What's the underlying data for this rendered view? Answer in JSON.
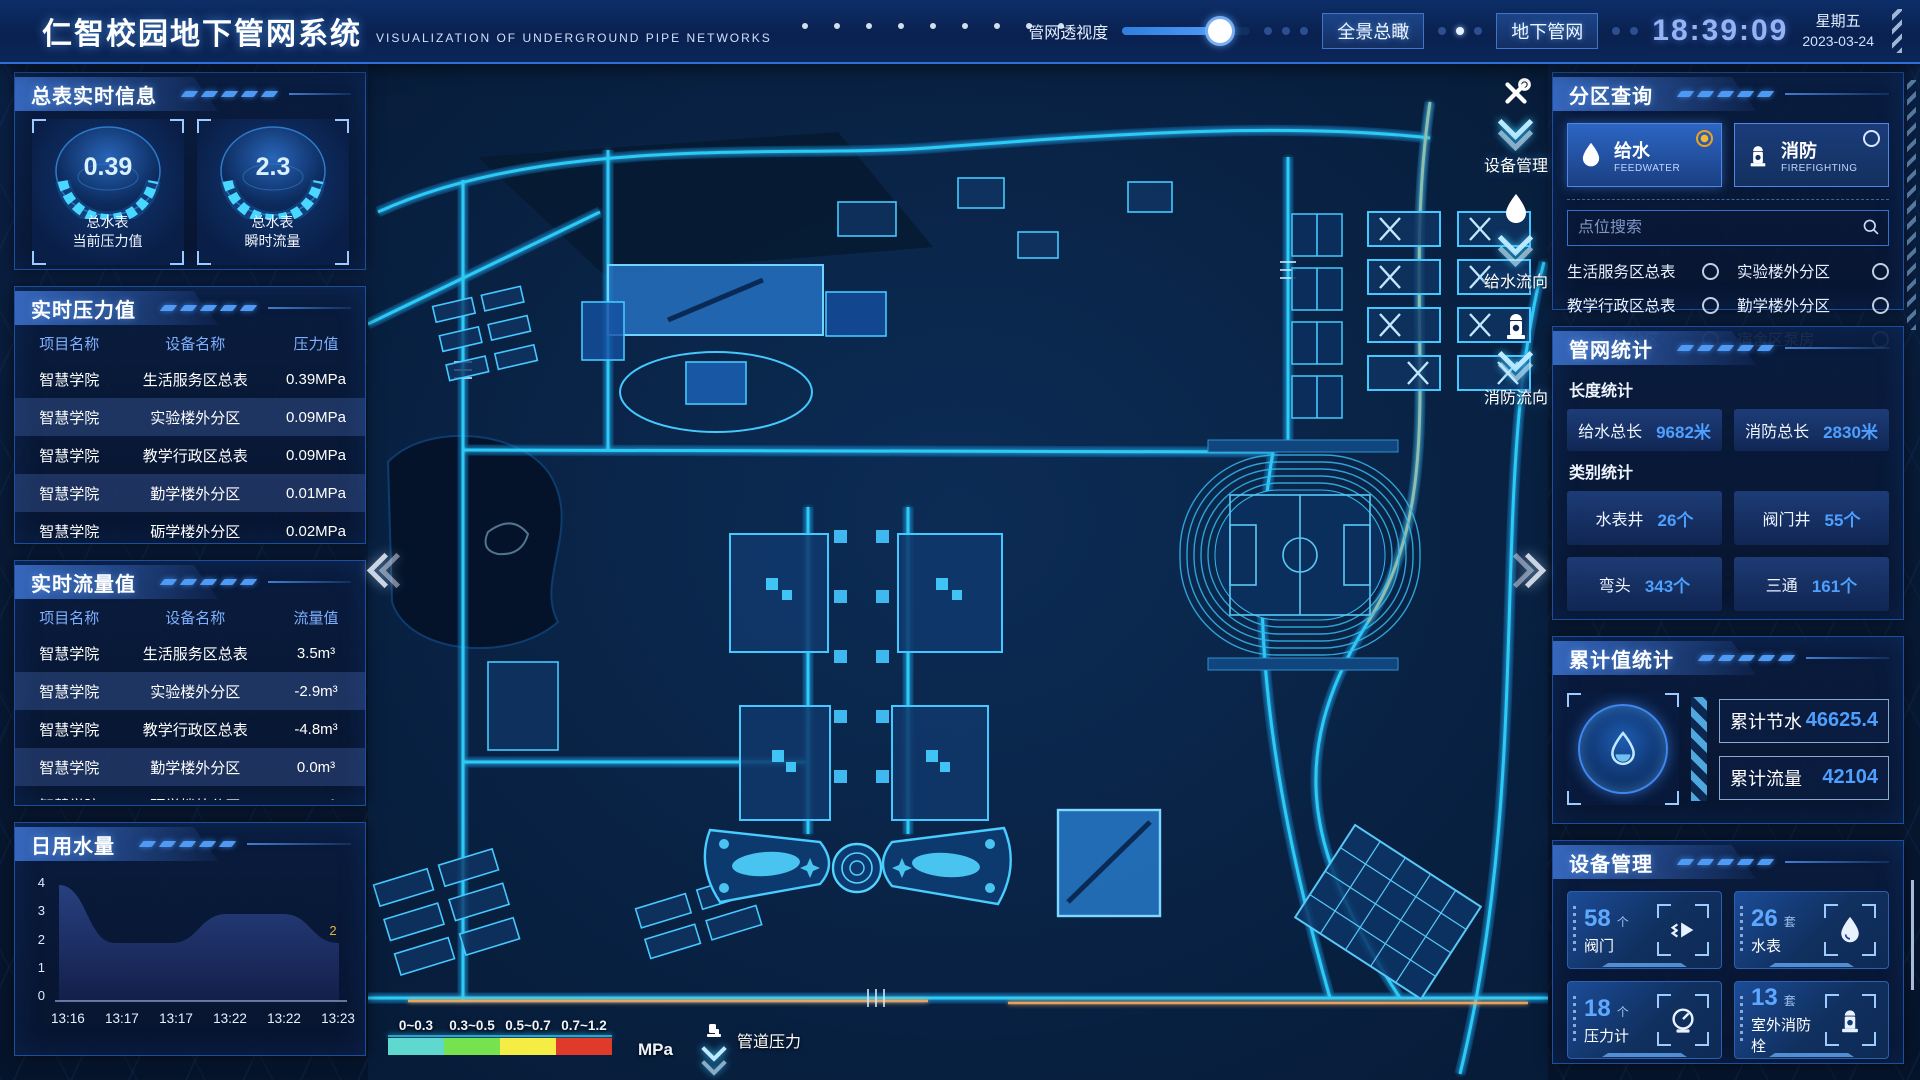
{
  "header": {
    "title": "仁智校园地下管网系统",
    "subtitle": "VISUALIZATION OF UNDERGROUND PIPE NETWORKS",
    "slider_label": "管网透视度",
    "btn_overview": "全景总瞰",
    "btn_underground": "地下管网",
    "time": "18:39:09",
    "weekday": "星期五",
    "date": "2023-03-24"
  },
  "left": {
    "meter_info": {
      "title": "总表实时信息",
      "gauges": [
        {
          "value": "0.39",
          "label1": "总水表",
          "label2": "当前压力值"
        },
        {
          "value": "2.3",
          "label1": "总水表",
          "label2": "瞬时流量"
        }
      ]
    },
    "pressure": {
      "title": "实时压力值",
      "headers": [
        "项目名称",
        "设备名称",
        "压力值"
      ],
      "rows": [
        [
          "智慧学院",
          "生活服务区总表",
          "0.39MPa"
        ],
        [
          "智慧学院",
          "实验楼外分区",
          "0.09MPa"
        ],
        [
          "智慧学院",
          "教学行政区总表",
          "0.09MPa"
        ],
        [
          "智慧学院",
          "勤学楼外分区",
          "0.01MPa"
        ],
        [
          "智慧学院",
          "砺学楼外分区",
          "0.02MPa"
        ]
      ]
    },
    "flow": {
      "title": "实时流量值",
      "headers": [
        "项目名称",
        "设备名称",
        "流量值"
      ],
      "rows": [
        [
          "智慧学院",
          "生活服务区总表",
          "3.5m³"
        ],
        [
          "智慧学院",
          "实验楼外分区",
          "-2.9m³"
        ],
        [
          "智慧学院",
          "教学行政区总表",
          "-4.8m³"
        ],
        [
          "智慧学院",
          "勤学楼外分区",
          "0.0m³"
        ],
        [
          "智慧学院",
          "砺学楼外分区",
          "2.3m³"
        ]
      ]
    },
    "daily": {
      "title": "日用水量"
    }
  },
  "chart_data": {
    "type": "area",
    "title": "日用水量",
    "x": [
      "13:16",
      "13:17",
      "13:17",
      "13:22",
      "13:22",
      "13:23"
    ],
    "values": [
      4,
      2,
      2,
      3,
      3,
      2
    ],
    "ylim": [
      0,
      4
    ],
    "yticks": [
      "4",
      "3",
      "2",
      "1",
      "0"
    ],
    "end_label": "2",
    "grid": false,
    "legend_position": "none"
  },
  "map": {
    "tools": [
      {
        "icon": "wrench-icon",
        "label": "设备管理"
      },
      {
        "icon": "waterdrop-icon",
        "label": "给水流向"
      },
      {
        "icon": "hydrant-icon",
        "label": "消防流向"
      }
    ],
    "legend": {
      "ranges": [
        {
          "label": "0~0.3",
          "color": "#5fd8cf"
        },
        {
          "label": "0.3~0.5",
          "color": "#76e24f"
        },
        {
          "label": "0.5~0.7",
          "color": "#f5ed43"
        },
        {
          "label": "0.7~1.2",
          "color": "#e03b2a"
        }
      ],
      "unit": "MPa",
      "pressure_label": "管道压力"
    }
  },
  "right": {
    "zone_query": {
      "title": "分区查询",
      "feedwater": {
        "cn": "给水",
        "en": "FEEDWATER"
      },
      "firefighting": {
        "cn": "消防",
        "en": "FIREFIGHTING"
      },
      "search_placeholder": "点位搜索",
      "points": [
        "生活服务区总表",
        "实验楼外分区",
        "教学行政区总表",
        "勤学楼外分区",
        "砺学楼外分区",
        "宿舍区泵房"
      ]
    },
    "pipe_stats": {
      "title": "管网统计",
      "length_title": "长度统计",
      "length_items": [
        {
          "label": "给水总长",
          "value": "9682米"
        },
        {
          "label": "消防总长",
          "value": "2830米"
        }
      ],
      "category_title": "类别统计",
      "category_items": [
        {
          "label": "水表井",
          "value": "26个"
        },
        {
          "label": "阀门井",
          "value": "55个"
        },
        {
          "label": "弯头",
          "value": "343个"
        },
        {
          "label": "三通",
          "value": "161个"
        }
      ]
    },
    "cumulative": {
      "title": "累计值统计",
      "items": [
        {
          "label": "累计节水",
          "value": "46625.4"
        },
        {
          "label": "累计流量",
          "value": "42104"
        }
      ]
    },
    "devices": {
      "title": "设备管理",
      "items": [
        {
          "count": "58",
          "unit": "个",
          "name": "阀门",
          "icon": "valve-icon"
        },
        {
          "count": "26",
          "unit": "套",
          "name": "水表",
          "icon": "water-meter-icon"
        },
        {
          "count": "18",
          "unit": "个",
          "name": "压力计",
          "icon": "pressure-gauge-icon"
        },
        {
          "count": "13",
          "unit": "套",
          "name": "室外消防栓",
          "icon": "hydrant-icon"
        }
      ]
    }
  }
}
